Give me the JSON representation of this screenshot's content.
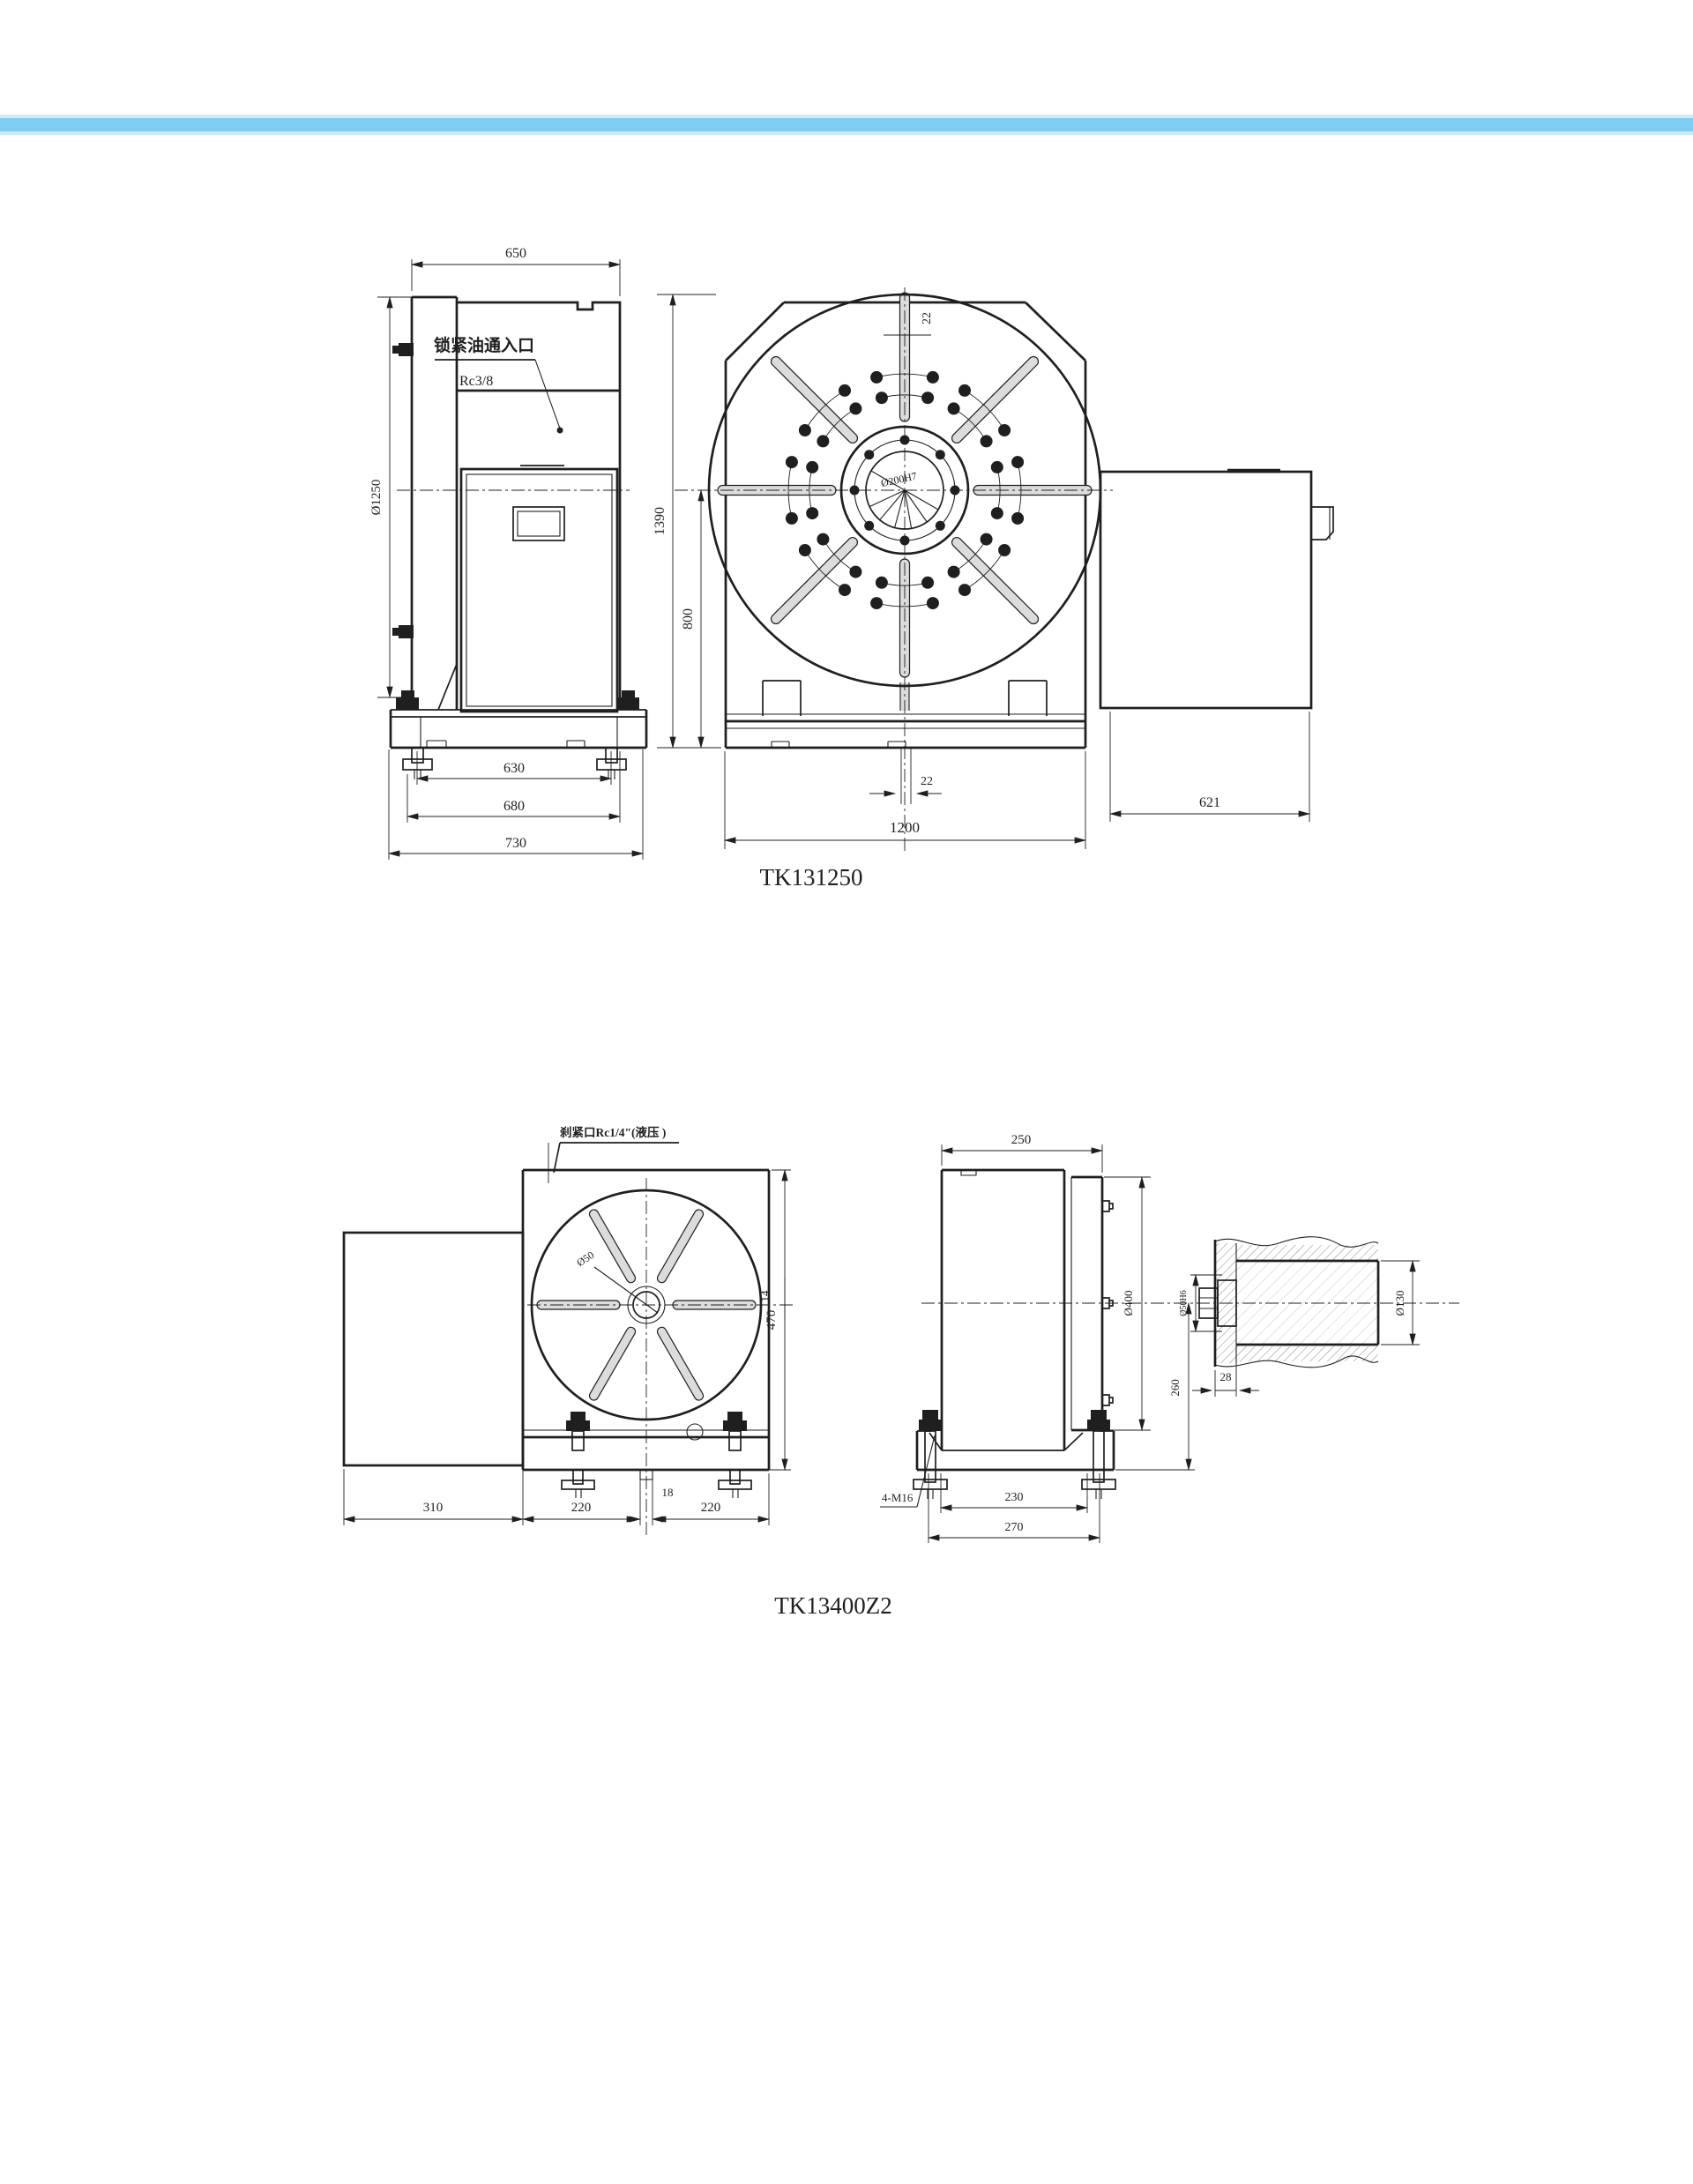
{
  "page": {
    "background": "#ffffff",
    "top_bar": {
      "core_color": "#7ccdf3",
      "edge_color": "#cfeafa"
    },
    "line_color": "#1f1f1f"
  },
  "drawing1": {
    "title": "TK131250",
    "labels": {
      "oil_inlet": "锁紧油通入口",
      "thread_spec": "Rc3/8",
      "hub_bore": "Ø200H7",
      "slot_width": "22"
    },
    "dims": {
      "top_width": "650",
      "table_diameter": "Ø1250",
      "overall_height": "1390",
      "center_height": "800",
      "slot_offset": "22",
      "overall_width": "1200",
      "base_inner": "630",
      "base_mid": "680",
      "base_outer": "730",
      "motor_length": "621"
    }
  },
  "drawing2": {
    "title": "TK13400Z2",
    "labels": {
      "clamp_port": "刹紧口Rc1/4\"(液压 )",
      "center_bore": "Ø50",
      "slot_width": "14",
      "anchor_bolts": "4-M16",
      "shaft_fit": "Ø50H6"
    },
    "dims": {
      "body_width": "250",
      "motor_width": "310",
      "base_left": "220",
      "center_slot": "18",
      "base_right": "220",
      "overall_height": "470",
      "faceplate_diameter": "Ø400",
      "center_height": "260",
      "flange_thickness": "28",
      "shaft_diameter": "Ø130",
      "foot_span_inner": "230",
      "foot_span_outer": "270"
    }
  }
}
